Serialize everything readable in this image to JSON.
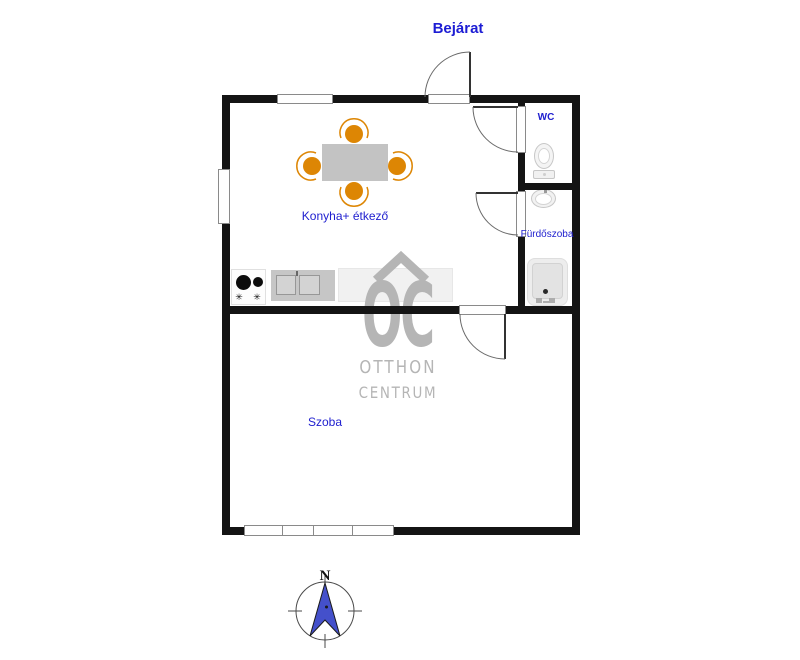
{
  "labels": {
    "entrance": "Bejárat"
  },
  "rooms": {
    "kitchen": {
      "label": "Konyha+ étkező"
    },
    "wc": {
      "label": "WC"
    },
    "bathroom": {
      "label": "Fürdőszoba"
    },
    "living": {
      "label": "Szoba"
    }
  },
  "watermark": {
    "monogram": "OC",
    "line1": "OTTHON",
    "line2": "CENTRUM",
    "color": "#b5b5b5"
  },
  "compass": {
    "north_label": "N",
    "needle_color": "#4450cb"
  },
  "icons": {
    "burner_star": "✳"
  },
  "colors": {
    "wall": "#141414",
    "label_blue": "#2020cf",
    "entrance_blue": "#1d1dd4",
    "chair_orange": "#dd8604",
    "table_gray": "#c3c3c3",
    "counter_gray": "#f1f1f1",
    "sink_gray": "#c6c6c6",
    "watermark_gray": "#b5b5b5"
  }
}
